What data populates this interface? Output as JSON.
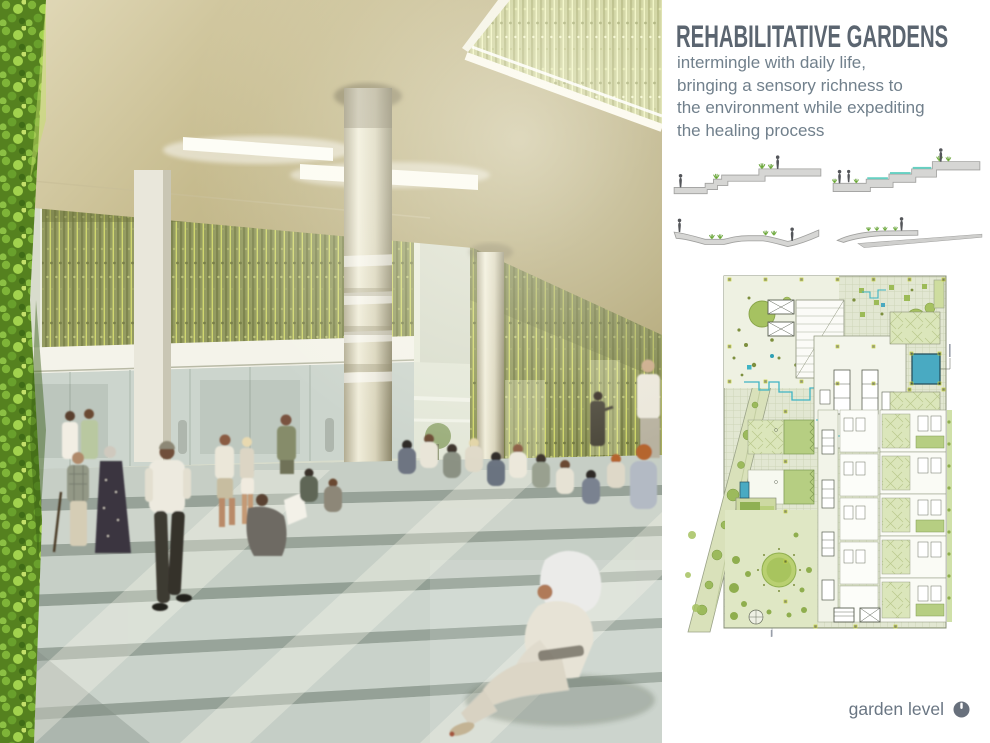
{
  "header": {
    "title": "REHABILITATIVE GARDENS",
    "description": "intermingle with daily life, bringing a sensory richness to the environment while expediting the healing process"
  },
  "plan": {
    "caption": "garden level"
  },
  "sections": {
    "items": [
      {
        "id": "stepped-terrace-garden-section"
      },
      {
        "id": "terraced-water-garden-section"
      },
      {
        "id": "undulating-path-garden-section"
      },
      {
        "id": "sloped-meadow-ramp-section"
      }
    ]
  },
  "palette": {
    "title_gray": "#5b6570",
    "body_text_gray": "#71808c",
    "plan_light_green": "#e2e7d2",
    "plan_tree_green": "#a6c261",
    "plan_dark_olive": "#7d8f3e",
    "pool_teal": "#49aac2",
    "stream_cyan": "#3fb4c4",
    "vine_olive": "#8d9456",
    "section_slab_gray": "#d6d6d4",
    "figure_gray": "#54565a",
    "water_teal": "#66d0c2",
    "step_concrete": "#c8d0c8",
    "ceiling_tan": "#c4b98c"
  }
}
